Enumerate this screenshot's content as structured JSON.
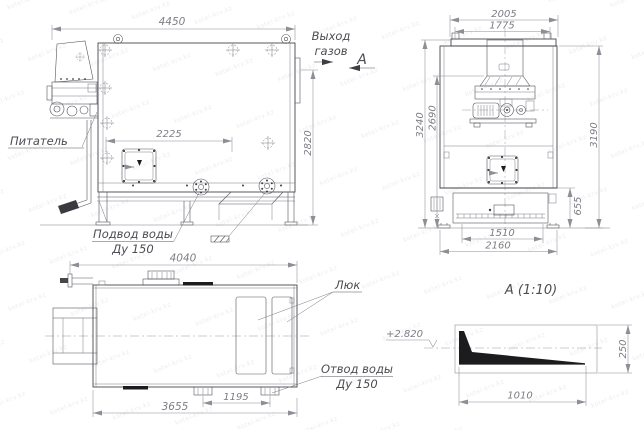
{
  "watermark": {
    "text": "kotel-krv.kz"
  },
  "side_view": {
    "feeder_label": "Питатель",
    "gas_outlet_label_1": "Выход",
    "gas_outlet_label_2": "газов",
    "section_letter": "А",
    "water_supply_label_1": "Подвод воды",
    "water_supply_label_2": "Ду 150",
    "dim_total_width": "4450",
    "dim_hatch": "2225",
    "dim_height": "2820"
  },
  "front_view": {
    "dim_top_width": "2005",
    "dim_top_inner_width": "1775",
    "dim_height_outer": "3240",
    "dim_height_inner": "2690",
    "dim_height_right": "3190",
    "dim_base_height": "655",
    "dim_base_width": "1510",
    "dim_total_width": "2160"
  },
  "plan_view": {
    "hatch_label": "Люк",
    "water_drain_label_1": "Отвод воды",
    "water_drain_label_2": "Ду 150",
    "dim_total_length": "4040",
    "dim_body_length": "3655",
    "dim_flange_spacing": "1195"
  },
  "detail_view": {
    "title": "А (1:10)",
    "elevation": "+2.820",
    "dim_length": "1010",
    "dim_height": "250"
  }
}
